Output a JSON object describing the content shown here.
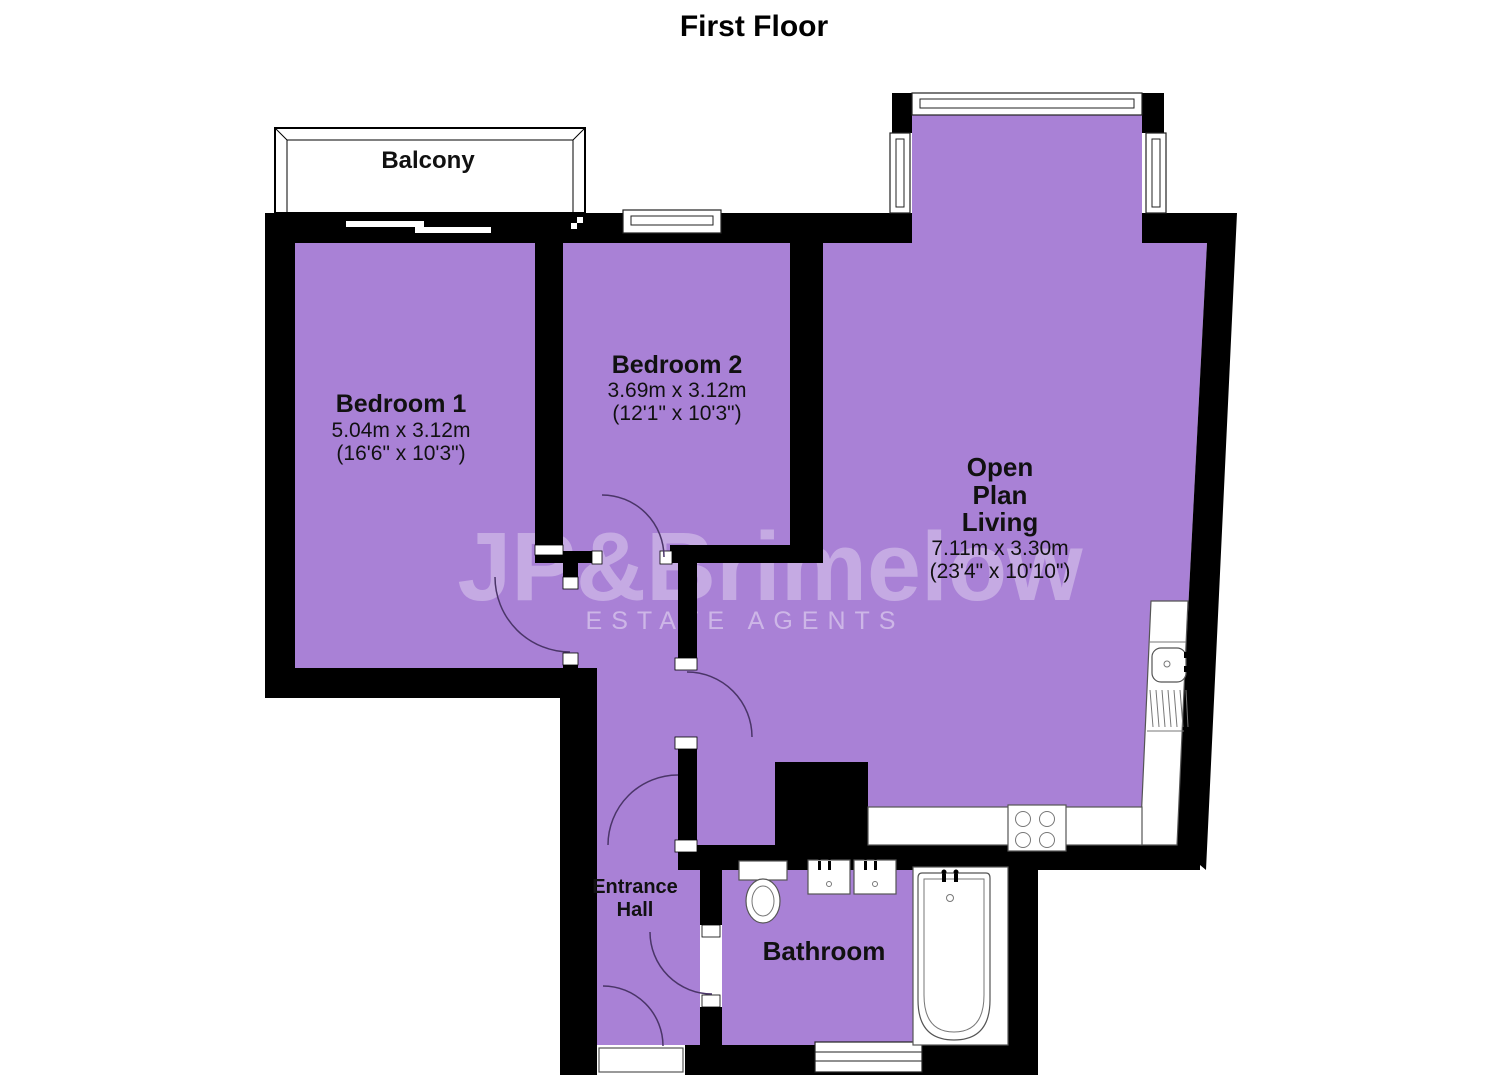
{
  "title": "First Floor",
  "balcony": {
    "label": "Balcony"
  },
  "rooms": {
    "bedroom1": {
      "name": "Bedroom 1",
      "metric": "5.04m x 3.12m",
      "imperial": "(16'6\" x 10'3\")"
    },
    "bedroom2": {
      "name": "Bedroom 2",
      "metric": "3.69m x 3.12m",
      "imperial": "(12'1\" x 10'3\")"
    },
    "open_plan_living": {
      "name_line1": "Open",
      "name_line2": "Plan",
      "name_line3": "Living",
      "metric": "7.11m x 3.30m",
      "imperial": "(23'4\" x 10'10\")"
    },
    "entrance_hall": {
      "name_line1": "Entrance",
      "name_line2": "Hall"
    },
    "bathroom": {
      "name": "Bathroom"
    }
  },
  "watermark": {
    "brand": "JP&Brimelow",
    "tagline": "ESTATE AGENTS"
  },
  "fixtures": {
    "kitchen": [
      "sink",
      "drainer",
      "hob",
      "counter"
    ],
    "bathroom": [
      "toilet",
      "basin",
      "basin",
      "bathtub"
    ]
  },
  "colors": {
    "floor": "#a981d6",
    "wall": "#000000",
    "door_arc": "#4a3568"
  }
}
